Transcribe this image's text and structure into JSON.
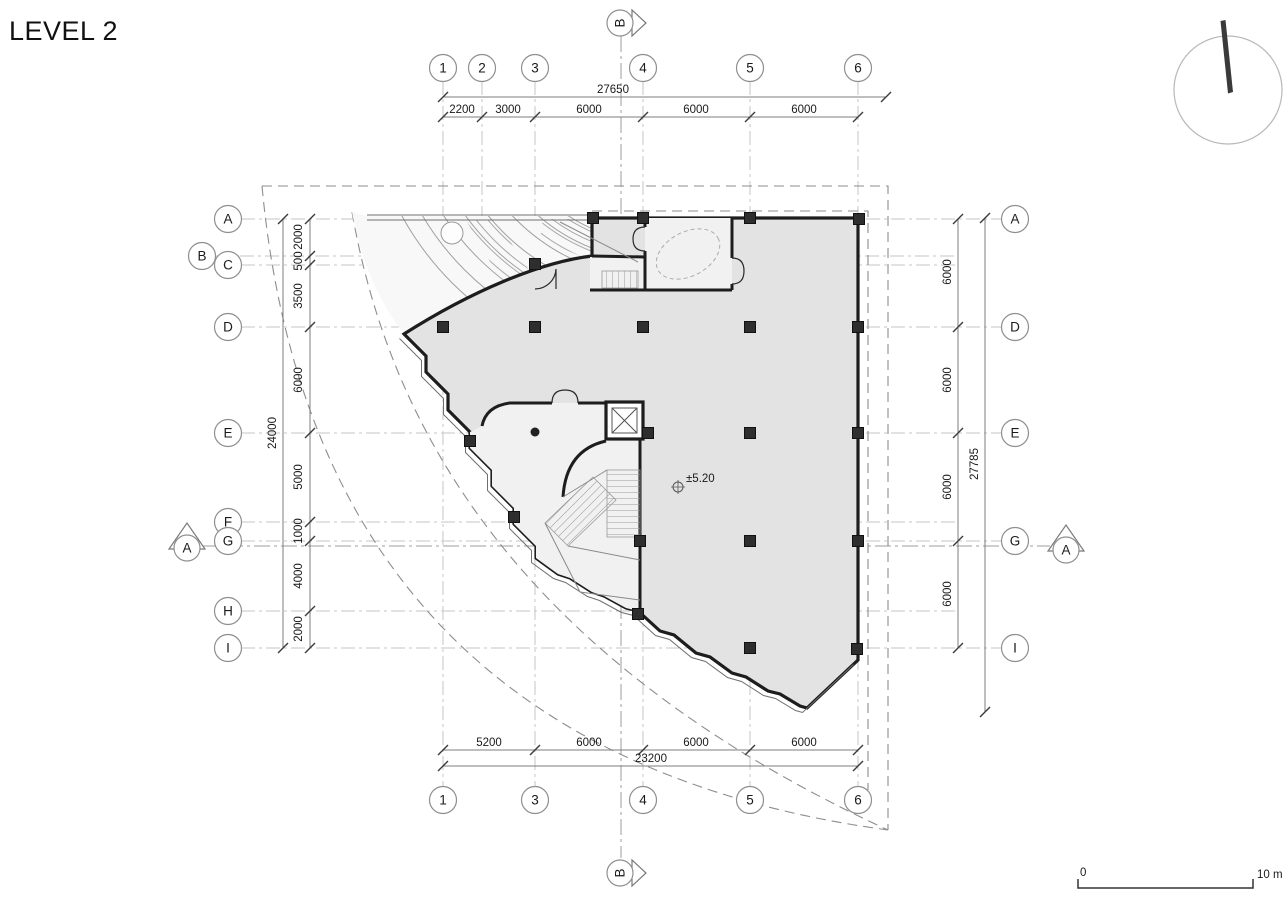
{
  "plan": {
    "title": "LEVEL 2"
  },
  "grid": {
    "top": [
      "1",
      "2",
      "3",
      "4",
      "5",
      "6"
    ],
    "bottom": [
      "1",
      "3",
      "4",
      "5",
      "6"
    ],
    "left": [
      "A",
      "B",
      "C",
      "D",
      "E",
      "F",
      "G",
      "H",
      "I"
    ],
    "right": [
      "A",
      "D",
      "E",
      "G",
      "I"
    ]
  },
  "sections": {
    "top": "B",
    "bottom": "B",
    "left": "A",
    "right": "A"
  },
  "dims": {
    "top_overall": "27650",
    "top_segments": [
      "2200",
      "3000",
      "6000",
      "6000",
      "6000"
    ],
    "bottom_overall": "23200",
    "bottom_segments": [
      "5200",
      "6000",
      "6000",
      "6000"
    ],
    "left_overall": "24000",
    "left_segments": [
      "2000",
      "500",
      "3500",
      "6000",
      "5000",
      "1000",
      "4000",
      "2000"
    ],
    "right_overall": "27785",
    "right_segments": [
      "6000",
      "6000",
      "6000",
      "6000"
    ]
  },
  "annotations": {
    "level_marker": "±5.20"
  },
  "scale_bar": {
    "zero": "0",
    "max": "10 m"
  },
  "colors": {
    "wall": "#1d1d1d",
    "floor_main": "#e3e3e3",
    "floor_light": "#f1f1f1",
    "terrace": "#f8f8f8",
    "grid_line": "#c6c6c6"
  }
}
